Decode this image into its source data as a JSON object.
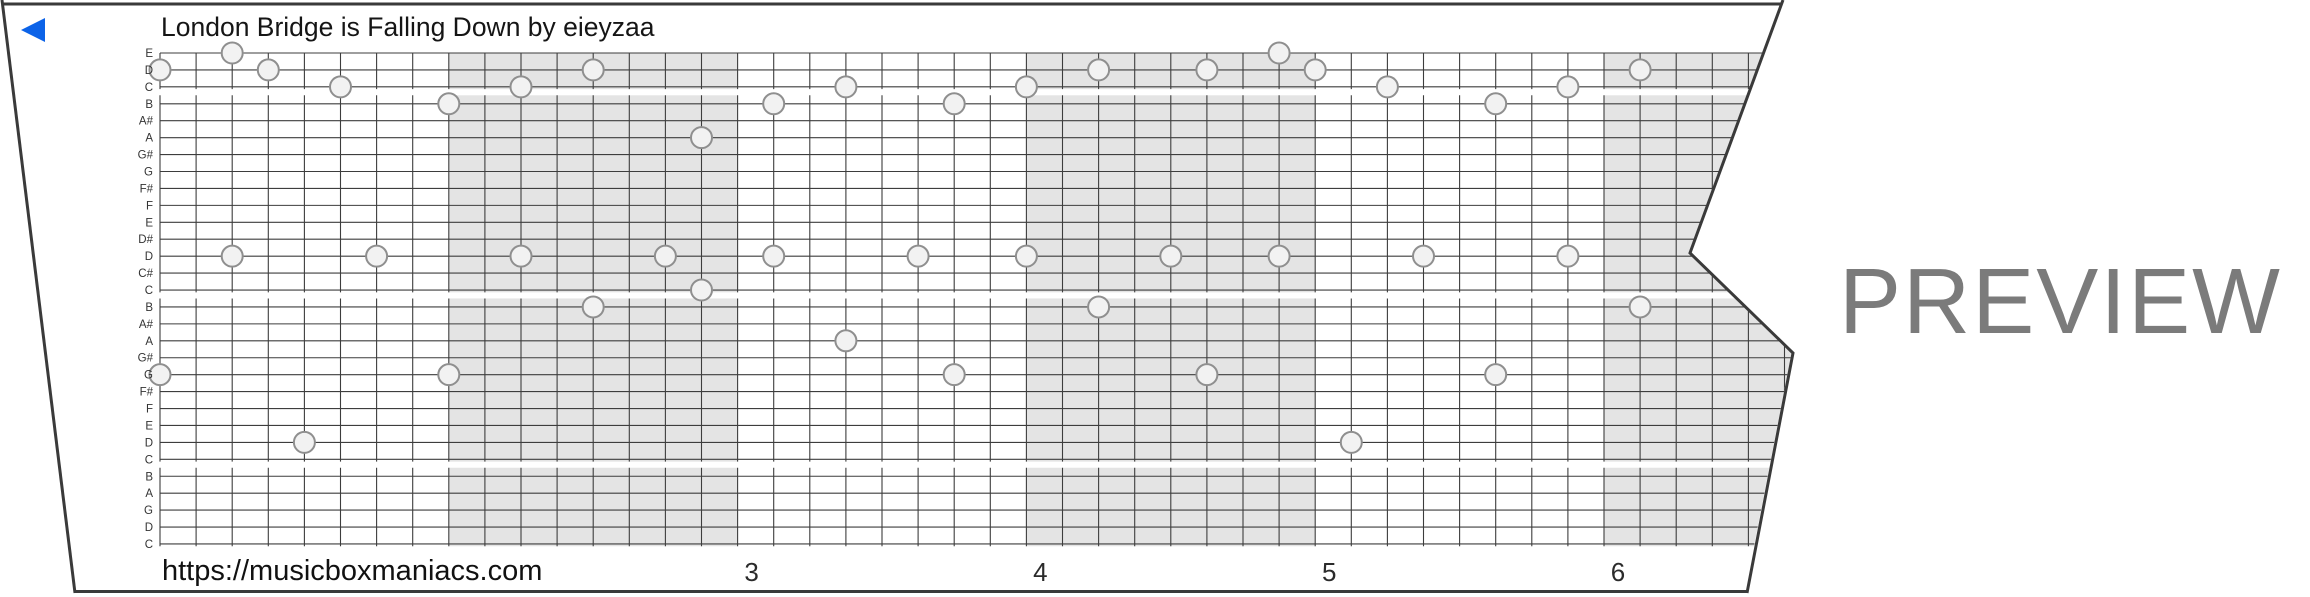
{
  "header": {
    "title": "London Bridge is Falling Down by eieyzaa"
  },
  "footer": {
    "url": "https://musicboxmaniacs.com"
  },
  "watermark": {
    "label": "PREVIEW"
  },
  "colors": {
    "background": "#ffffff",
    "strip_border": "#3a3a3a",
    "grid_line": "#3d3d3d",
    "measure_shading": "#e4e4e4",
    "note_fill": "#f2f2f2",
    "note_stroke": "#8f8f8f",
    "arrow_blue": "#0c63e8",
    "preview_gray": "#7b7b7b",
    "row_label_color": "#333333",
    "measure_number_color": "#2b2b2b"
  },
  "grid": {
    "row_labels": [
      "E",
      "D",
      "C",
      "B",
      "A#",
      "A",
      "G#",
      "G",
      "F#",
      "F",
      "E",
      "D#",
      "D",
      "C#",
      "C",
      "B",
      "A#",
      "A",
      "G#",
      "G",
      "F#",
      "F",
      "E",
      "D",
      "C",
      "B",
      "A",
      "G",
      "D",
      "C"
    ],
    "section_row_spans": [
      [
        1,
        3
      ],
      [
        4,
        15
      ],
      [
        16,
        25
      ],
      [
        26,
        30
      ]
    ],
    "columns_per_measure": 8,
    "shaded_measure_start_cols": [
      8,
      24,
      40
    ],
    "measure_numbers": [
      {
        "label": "3",
        "col": 16
      },
      {
        "label": "4",
        "col": 24
      },
      {
        "label": "5",
        "col": 32
      },
      {
        "label": "6",
        "col": 40
      }
    ],
    "notes": [
      {
        "c": 0,
        "r": 2
      },
      {
        "c": 0,
        "r": 20
      },
      {
        "c": 2,
        "r": 1
      },
      {
        "c": 2,
        "r": 13
      },
      {
        "c": 3,
        "r": 2
      },
      {
        "c": 4,
        "r": 24
      },
      {
        "c": 5,
        "r": 3
      },
      {
        "c": 6,
        "r": 13
      },
      {
        "c": 8,
        "r": 4
      },
      {
        "c": 8,
        "r": 20
      },
      {
        "c": 10,
        "r": 3
      },
      {
        "c": 10,
        "r": 13
      },
      {
        "c": 12,
        "r": 2
      },
      {
        "c": 12,
        "r": 16
      },
      {
        "c": 14,
        "r": 13
      },
      {
        "c": 15,
        "r": 6
      },
      {
        "c": 15,
        "r": 15
      },
      {
        "c": 17,
        "r": 4
      },
      {
        "c": 17,
        "r": 13
      },
      {
        "c": 19,
        "r": 3
      },
      {
        "c": 19,
        "r": 18
      },
      {
        "c": 21,
        "r": 13
      },
      {
        "c": 22,
        "r": 4
      },
      {
        "c": 22,
        "r": 20
      },
      {
        "c": 24,
        "r": 3
      },
      {
        "c": 24,
        "r": 13
      },
      {
        "c": 26,
        "r": 2
      },
      {
        "c": 26,
        "r": 16
      },
      {
        "c": 28,
        "r": 13
      },
      {
        "c": 29,
        "r": 2
      },
      {
        "c": 29,
        "r": 20
      },
      {
        "c": 31,
        "r": 1
      },
      {
        "c": 31,
        "r": 13
      },
      {
        "c": 32,
        "r": 2
      },
      {
        "c": 33,
        "r": 24
      },
      {
        "c": 34,
        "r": 3
      },
      {
        "c": 35,
        "r": 13
      },
      {
        "c": 37,
        "r": 4
      },
      {
        "c": 37,
        "r": 20
      },
      {
        "c": 39,
        "r": 3
      },
      {
        "c": 39,
        "r": 13
      },
      {
        "c": 41,
        "r": 2
      },
      {
        "c": 41,
        "r": 16
      }
    ]
  }
}
